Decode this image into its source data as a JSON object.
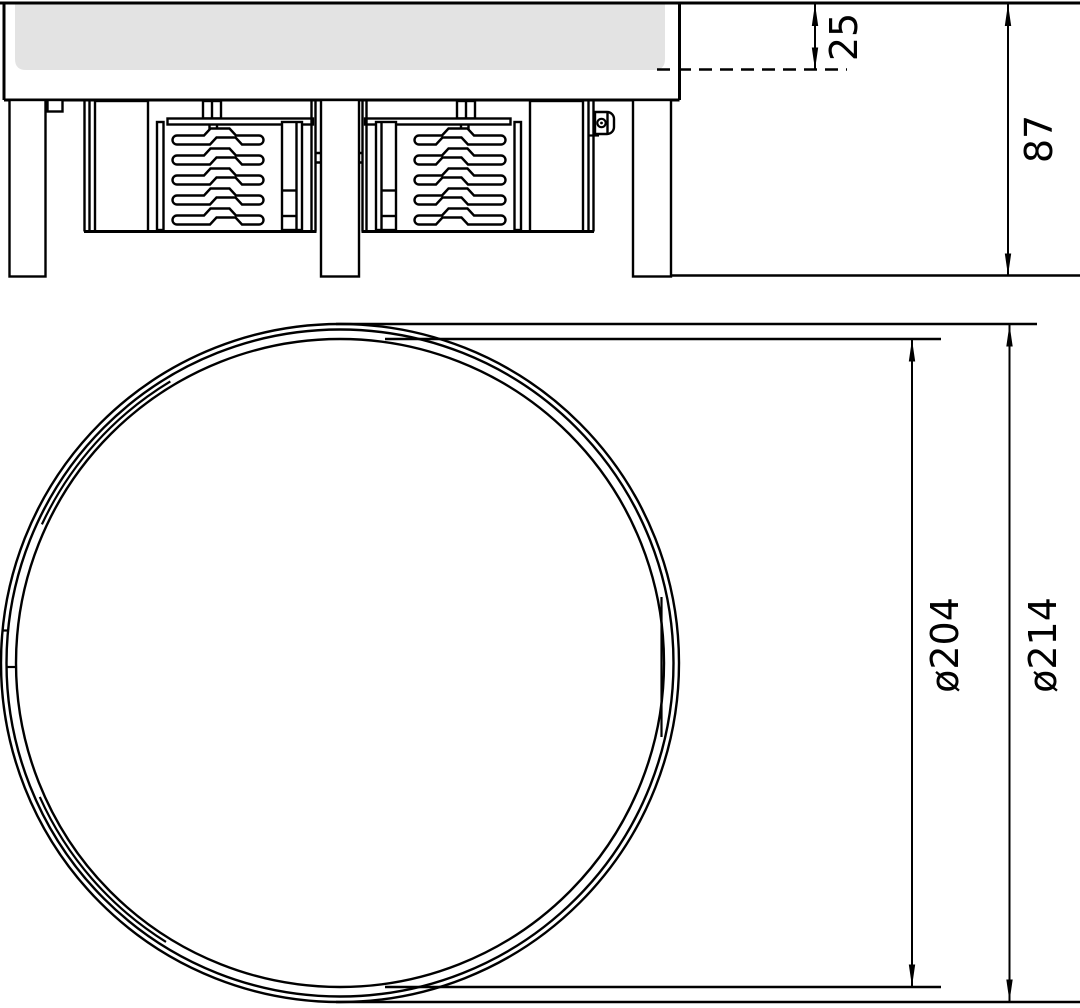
{
  "dimensions": {
    "recess_depth": "25",
    "overall_height": "87",
    "inner_diameter": "ø204",
    "outer_diameter": "ø214"
  },
  "colors": {
    "line": "#000000",
    "background": "#ffffff",
    "panel": "#e3e3e3"
  }
}
